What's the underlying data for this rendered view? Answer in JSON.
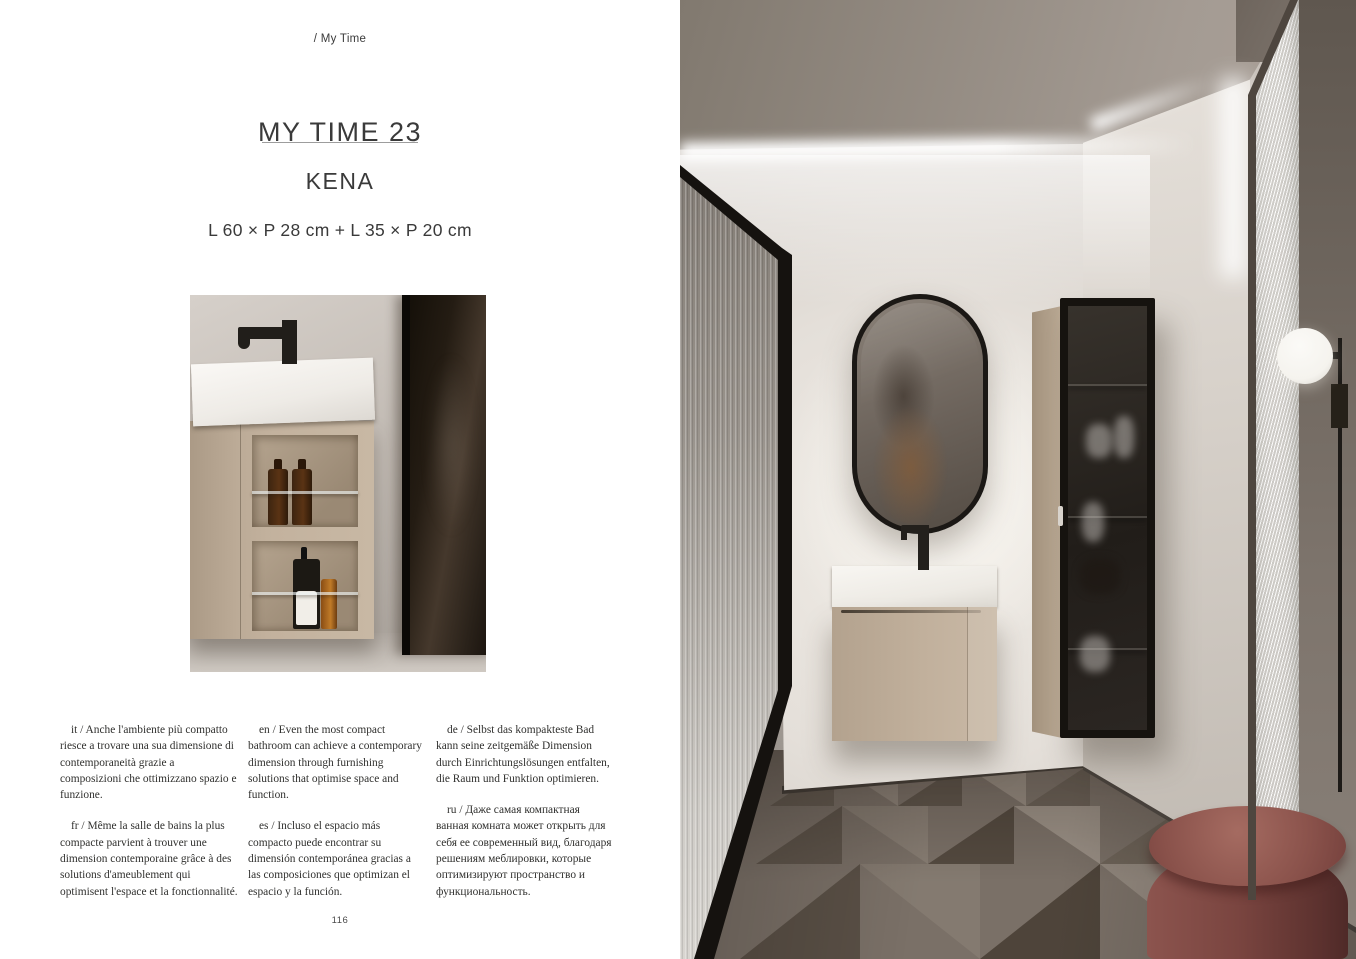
{
  "left_page": {
    "breadcrumb": "/ My Time",
    "title": "MY TIME 23",
    "subtitle": "KENA",
    "dimensions": "L 60 × P 28 cm + L 35 × P 20 cm",
    "page_number": "116",
    "description_columns": [
      {
        "paragraphs": [
          "it / Anche l'ambiente più compatto riesce a trovare una sua dimensione di contemporaneità grazie a composizioni che ottimizzano spazio e funzione.",
          "fr / Même la salle de bains la plus compacte parvient à trouver une dimension contemporaine grâce à des solutions d'ameublement qui optimisent l'espace et la fonctionnalité."
        ]
      },
      {
        "paragraphs": [
          "en / Even the most compact bathroom can achieve a contemporary dimension through furnishing solutions that optimise space and function.",
          "es / Incluso el espacio más compacto puede encontrar su dimensión contemporánea gracias a las composiciones que optimizan el espacio y la función."
        ]
      },
      {
        "paragraphs": [
          "de / Selbst das kompakteste Bad kann seine zeitgemäße Dimension durch Einrichtungslösungen entfalten, die Raum und Funktion optimieren.",
          "ru / Даже самая компактная ванная комната может открыть для себя ее современный вид, благодаря решениям меблировки, которые оптимизируют пространство и функциональность."
        ]
      }
    ]
  },
  "colors": {
    "paper": "#ffffff",
    "ink": "#3a3a3a",
    "body_ink": "#30302e",
    "wood": "#c1b09c",
    "basin": "#f3f1ec",
    "frame_black": "#16130f",
    "wall": "#e5e0da",
    "ceiling": "#a49b93",
    "right_wall_dark": "#6e655d",
    "floor_base": "#7a7067",
    "pouf": "#7a4540",
    "lamp": "#f5f3ee"
  }
}
